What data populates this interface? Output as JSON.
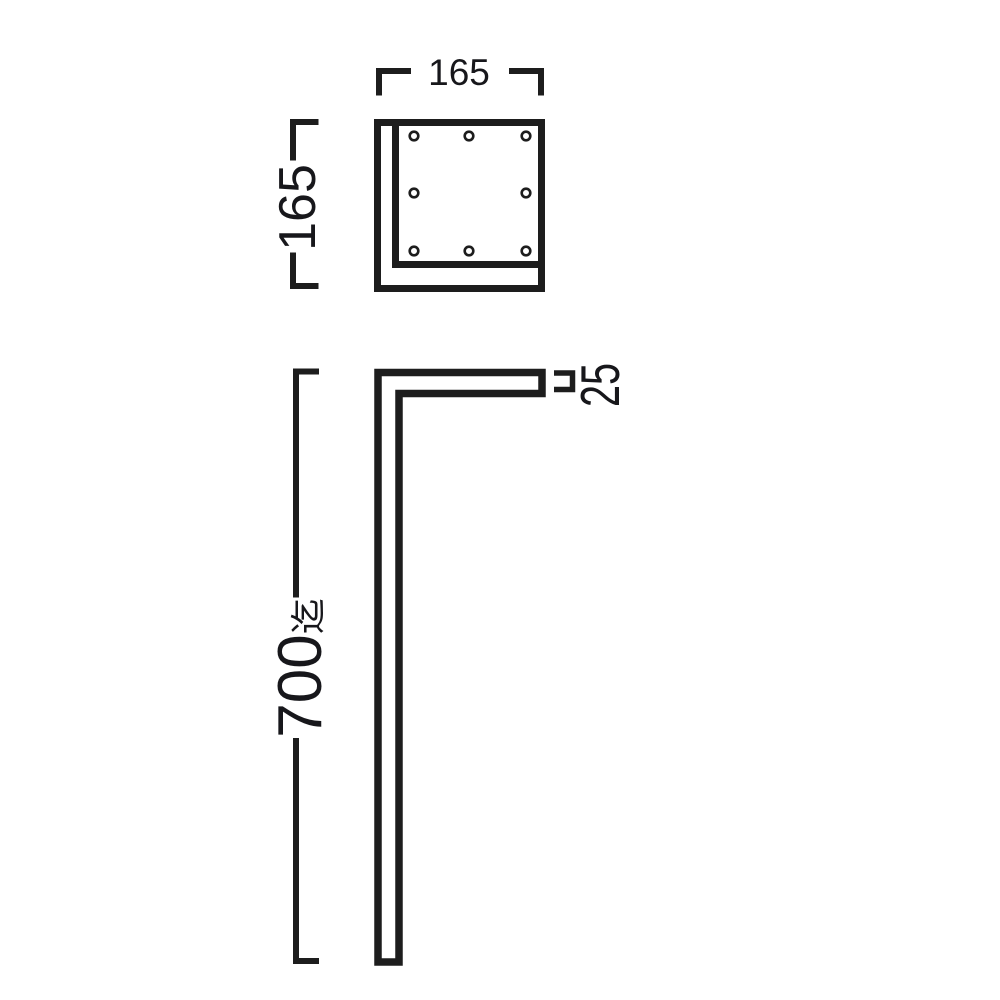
{
  "top_view": {
    "width_label": "165",
    "depth_label": "165",
    "screw_hole_count": 8
  },
  "side_view": {
    "height_value": "700",
    "height_suffix": "迄",
    "thickness_label": "25"
  },
  "colors": {
    "background": "#ffffff",
    "line_color": "#1d1d1d",
    "text_color": "#17171b"
  }
}
